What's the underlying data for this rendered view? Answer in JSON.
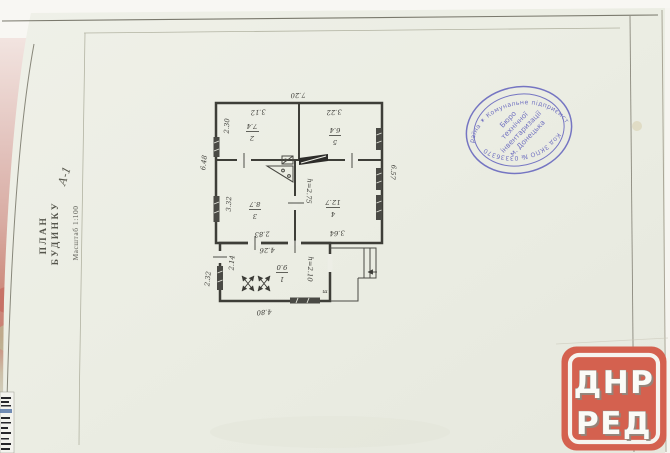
{
  "document": {
    "side_title": {
      "line1": "ПЛАН",
      "line2": "БУДИНКУ",
      "house_letter": "А-1",
      "scale_note": "Масштаб 1:100"
    }
  },
  "floor_plan": {
    "overall": {
      "top_width": "7.20",
      "left_height": "6.48",
      "right_height": "6.57"
    },
    "rooms": [
      {
        "id": "room-2",
        "number": "2",
        "area": "7.4"
      },
      {
        "id": "room-5",
        "number": "5",
        "area": "6.4"
      },
      {
        "id": "room-3",
        "number": "3",
        "area": "8.7"
      },
      {
        "id": "room-4",
        "number": "4",
        "area": "12.7"
      },
      {
        "id": "room-1",
        "number": "1",
        "area": "9.0"
      }
    ],
    "dims": {
      "room2_width": "3.12",
      "room2_depth": "2.30",
      "room5_width": "3.22",
      "room3_depth": "3.32",
      "room3_width": "2.83",
      "room4_width": "3.64",
      "room4_height_note": "h=2.75",
      "annex_top_width": "4.26",
      "annex_bottom_width": "4.80",
      "annex_inner_depth": "2.14",
      "annex_outer_depth": "2.32",
      "annex_height_note": "h=2.10",
      "tap_mark": "т"
    }
  },
  "stamp": {
    "arc_top": "Україна ✶ Комунальне підприємство",
    "arc_bottom": "Код ЗКПО № 03336370",
    "center_lines": [
      "Бюро",
      "технічної",
      "інвентаризації",
      "м. Донецька"
    ],
    "ink_color": "#5c5cba"
  },
  "watermark": {
    "line1": "ДНР",
    "line2": "РЕД",
    "bg_color": "#d4614f",
    "border_color": "#f6f4ef",
    "text_color": "#fbfbf7"
  }
}
